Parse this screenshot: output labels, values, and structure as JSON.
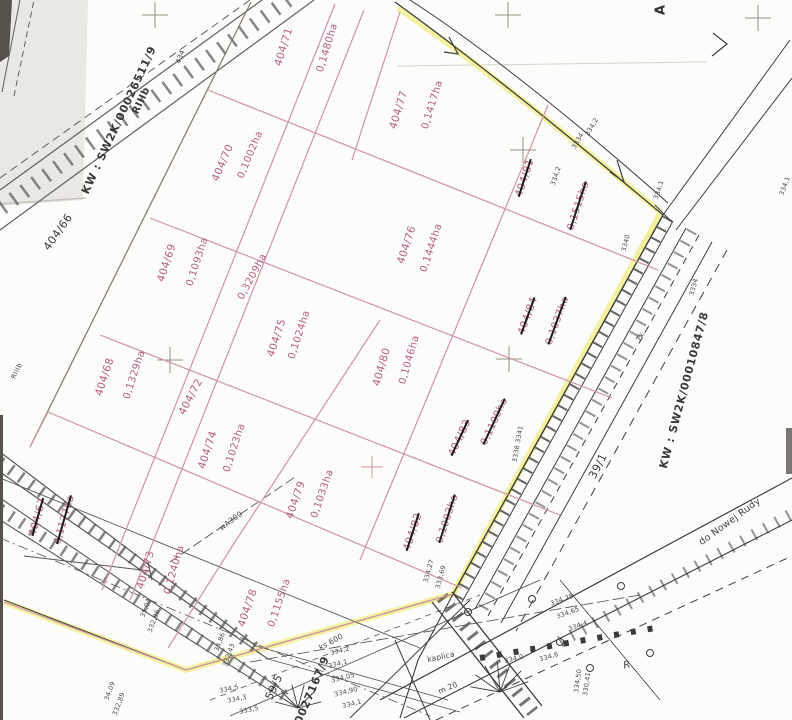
{
  "map_type": "cadastral-parcel-map",
  "colors": {
    "parcel_text_pink": "#b55f7b",
    "parcel_line_pink": "#cf93a4",
    "boundary_highlight_yellow": "#f3f096",
    "ink_black": "#3d3d3d",
    "survey_cross_grey": "#8f957c"
  },
  "parcels": [
    {
      "id": "404/71",
      "area": "0,1480ha",
      "crossed": false
    },
    {
      "id": "404/70",
      "area": "0,1002ha",
      "crossed": false
    },
    {
      "id": "404/77",
      "area": "0,1417ha",
      "crossed": false
    },
    {
      "id": "404/81",
      "area": "0,1515ha",
      "crossed": true
    },
    {
      "id": "404/69",
      "area": "0,1093ha",
      "crossed": false
    },
    {
      "id": "404/76",
      "area": "0,1444ha",
      "crossed": false
    },
    {
      "id": "404/72",
      "area": "0,3209ha",
      "crossed": false
    },
    {
      "id": "404/68",
      "area": "0,1329ha",
      "crossed": false
    },
    {
      "id": "404/75",
      "area": "0,1024ha",
      "crossed": false
    },
    {
      "id": "404/80",
      "area": "0,1046ha",
      "crossed": false
    },
    {
      "id": "404/84",
      "area": "0,1037ha",
      "crossed": true
    },
    {
      "id": "404/74",
      "area": "0,1023ha",
      "crossed": false
    },
    {
      "id": "404/83",
      "area": "0,1100ha",
      "crossed": true
    },
    {
      "id": "404/79",
      "area": "0,1033ha",
      "crossed": false
    },
    {
      "id": "404/67",
      "area": "0,1177ha",
      "crossed": true
    },
    {
      "id": "404/82",
      "area": "0,1003ha",
      "crossed": true
    },
    {
      "id": "404/73",
      "area": "0,1240ha",
      "crossed": false
    },
    {
      "id": "404/78",
      "area": "0,1155ha",
      "crossed": false
    }
  ],
  "neighbour_parcels": {
    "west": "404/66",
    "south": "59/5",
    "road": "39/1"
  },
  "kw_labels": {
    "railway_left": "KW : SW2K/00026511/9",
    "road_right": "KW : SW2K/00010847/8",
    "bottom_partial": "0027167/9"
  },
  "soil_classes": {
    "main": "RIIIb",
    "small": "RIIIb"
  },
  "road": {
    "destination": "do Nowej Rudy"
  },
  "marks": {
    "north_a": "A",
    "r_mark": "R",
    "water_pipe": "wA300",
    "sewer": "ks 600",
    "chapel": "kaplica",
    "m20": "m 20",
    "pt434": "434",
    "pt7k": "7k."
  },
  "elevations": [
    "334,2",
    "3334",
    "334,2",
    "334,1",
    "3340",
    "3334",
    "3338  3341",
    "334,1",
    "334,27",
    "333,69",
    "35,04",
    "332,96",
    "34,86",
    "332,43",
    "34,09",
    "332,89",
    "334,2",
    "334,1",
    "334,05",
    "334,90",
    "334,1",
    "334,5",
    "334,3",
    "333,5",
    "334,25",
    "334,65",
    "334,4",
    "334,6",
    "334,50",
    "330,41",
    "334,0"
  ]
}
